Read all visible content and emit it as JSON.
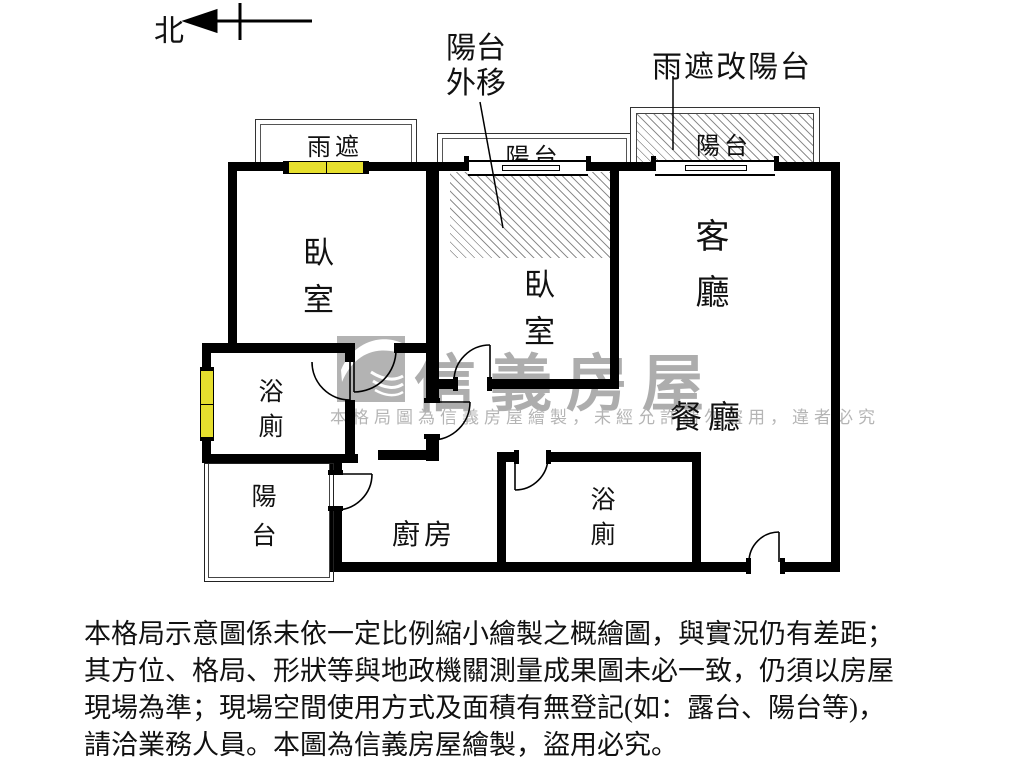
{
  "compass": {
    "north_label": "北"
  },
  "annotations": {
    "balcony_out_line1": "陽台",
    "balcony_out_line2": "外移",
    "rain_to_balcony": "雨遮改陽台"
  },
  "labels": {
    "rain_cover": "雨遮",
    "balcony_mid": "陽台",
    "balcony_right": "陽台",
    "bedroom_left": "臥室",
    "bedroom_mid": "臥室",
    "living_room": "客廳",
    "dining_room": "餐廳",
    "bath_left": "浴廁",
    "bath_right": "浴廁",
    "balcony_bottom": "陽台",
    "kitchen": "廚房"
  },
  "watermark": {
    "brand": "信義房屋",
    "notice": "本格局圖為信義房屋繪製，未經允許請勿盜用，違者必究"
  },
  "disclaimer": [
    "本格局示意圖係未依一定比例縮小繪製之概繪圖，與實況仍有差距；",
    "其方位、格局、形狀等與地政機關測量成果圖未必一致，仍須以房屋",
    "現場為準；現場空間使用方式及面積有無登記(如：露台、陽台等)，",
    "請洽業務人員。本圖為信義房屋繪製，盜用必究。"
  ],
  "colors": {
    "wall": "#000000",
    "window": "#e6df2e",
    "watermark_gray": "#adadad"
  }
}
